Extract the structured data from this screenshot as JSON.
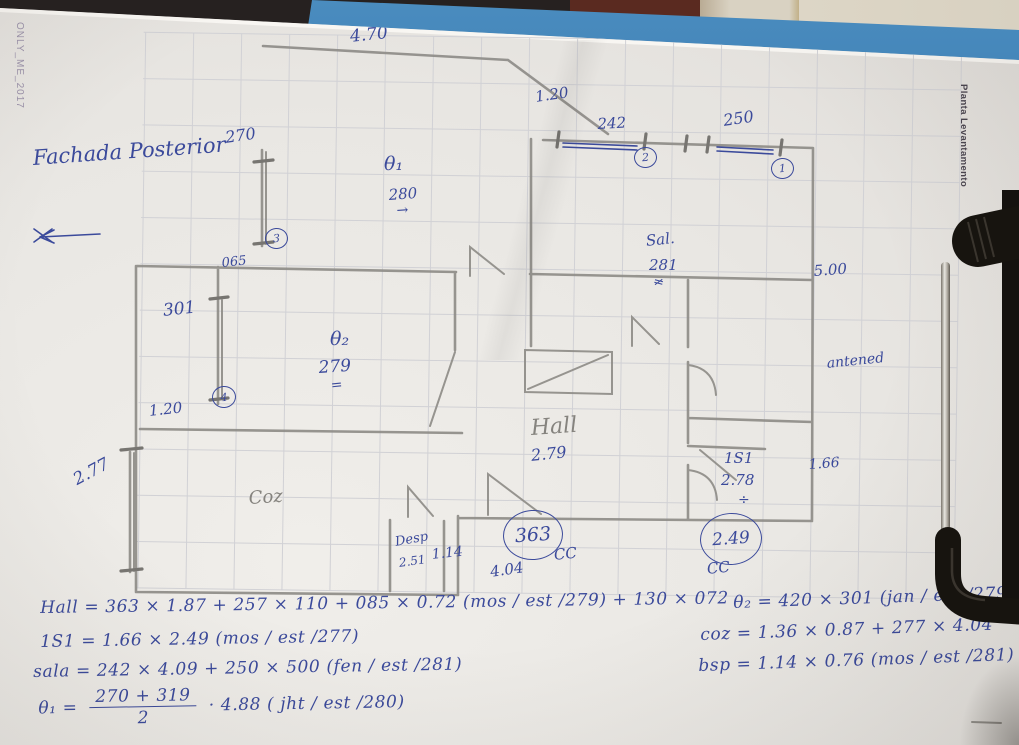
{
  "colors": {
    "ink": "#3b4a9b",
    "pencil": "#8f8d88",
    "clipboard_blue": "#2f6fa8",
    "paper": "#e9e7e3"
  },
  "side_labels": {
    "left_vertical": "ONLY_ME_2017",
    "right_vertical": "Planta Levantamento"
  },
  "header_note": {
    "text": "Fachada Posterior"
  },
  "plan": {
    "annotations": [
      {
        "name": "dim-470",
        "text": "4.70",
        "x": 349,
        "y": 27,
        "size": 17,
        "color": "ink",
        "rot": -6
      },
      {
        "name": "dim-270",
        "text": "270",
        "x": 224,
        "y": 128,
        "size": 16,
        "color": "ink",
        "rot": -8
      },
      {
        "name": "dim-120-top",
        "text": "1.20",
        "x": 534,
        "y": 88,
        "size": 15,
        "color": "ink",
        "rot": -8
      },
      {
        "name": "dim-242",
        "text": "242",
        "x": 597,
        "y": 115,
        "size": 15,
        "color": "ink",
        "rot": -3
      },
      {
        "name": "dim-250",
        "text": "250",
        "x": 722,
        "y": 111,
        "size": 16,
        "color": "ink",
        "rot": -8
      },
      {
        "name": "label-theta1",
        "text": "θ₁",
        "x": 384,
        "y": 153,
        "size": 19,
        "color": "ink",
        "rot": 0
      },
      {
        "name": "dim-280",
        "text": "280",
        "x": 388,
        "y": 186,
        "size": 15,
        "color": "ink",
        "rot": -4
      },
      {
        "name": "arrow-280",
        "text": "→",
        "x": 396,
        "y": 203,
        "size": 14,
        "color": "ink",
        "rot": -4
      },
      {
        "name": "room-sala",
        "text": "Sal.",
        "x": 645,
        "y": 232,
        "size": 15,
        "color": "ink",
        "rot": -6
      },
      {
        "name": "dim-281",
        "text": "281",
        "x": 649,
        "y": 256,
        "size": 15,
        "color": "ink",
        "rot": 0
      },
      {
        "name": "mark-281",
        "text": "≠",
        "x": 655,
        "y": 274,
        "size": 13,
        "color": "ink",
        "rot": 14
      },
      {
        "name": "dim-500",
        "text": "5.00",
        "x": 813,
        "y": 262,
        "size": 15,
        "color": "ink",
        "rot": -4
      },
      {
        "name": "note-antened",
        "text": "antened",
        "x": 826,
        "y": 356,
        "size": 14,
        "color": "ink",
        "rot": -6
      },
      {
        "name": "dim-065",
        "text": "065",
        "x": 221,
        "y": 256,
        "size": 13,
        "color": "ink",
        "rot": -6
      },
      {
        "name": "dim-301",
        "text": "301",
        "x": 162,
        "y": 301,
        "size": 17,
        "color": "ink",
        "rot": -6
      },
      {
        "name": "label-theta2",
        "text": "θ₂",
        "x": 330,
        "y": 328,
        "size": 19,
        "color": "ink",
        "rot": 0
      },
      {
        "name": "dim-279-theta2",
        "text": "279",
        "x": 318,
        "y": 358,
        "size": 17,
        "color": "ink",
        "rot": -4
      },
      {
        "name": "mark-279",
        "text": "=",
        "x": 330,
        "y": 378,
        "size": 14,
        "color": "ink",
        "rot": -6
      },
      {
        "name": "dim-120-left",
        "text": "1.20",
        "x": 148,
        "y": 402,
        "size": 15,
        "color": "ink",
        "rot": -6
      },
      {
        "name": "dim-277-left",
        "text": "2.77",
        "x": 70,
        "y": 472,
        "size": 17,
        "color": "ink",
        "rot": -28
      },
      {
        "name": "room-hall",
        "text": "Hall",
        "x": 530,
        "y": 416,
        "size": 22,
        "color": "pencil",
        "rot": -4
      },
      {
        "name": "dim-279-hall",
        "text": "2.79",
        "x": 530,
        "y": 446,
        "size": 16,
        "color": "ink",
        "rot": -6
      },
      {
        "name": "room-coz",
        "text": "Coz",
        "x": 248,
        "y": 488,
        "size": 18,
        "color": "pencil",
        "rot": -4
      },
      {
        "name": "room-desp",
        "text": "Desp",
        "x": 394,
        "y": 535,
        "size": 13,
        "color": "ink",
        "rot": -10
      },
      {
        "name": "dim-251",
        "text": "2.51",
        "x": 398,
        "y": 556,
        "size": 12,
        "color": "ink",
        "rot": -8
      },
      {
        "name": "dim-114",
        "text": "1.14",
        "x": 431,
        "y": 547,
        "size": 14,
        "color": "ink",
        "rot": -6
      },
      {
        "name": "room-1s1",
        "text": "1S1",
        "x": 724,
        "y": 449,
        "size": 15,
        "color": "ink",
        "rot": 0
      },
      {
        "name": "dim-278",
        "text": "2.78",
        "x": 721,
        "y": 471,
        "size": 15,
        "color": "ink",
        "rot": 0
      },
      {
        "name": "mark-divide",
        "text": "÷",
        "x": 738,
        "y": 492,
        "size": 14,
        "color": "ink",
        "rot": 0
      },
      {
        "name": "dim-166",
        "text": "1.66",
        "x": 808,
        "y": 457,
        "size": 14,
        "color": "ink",
        "rot": -4
      },
      {
        "name": "dim-404",
        "text": "4.04",
        "x": 489,
        "y": 563,
        "size": 15,
        "color": "ink",
        "rot": -8
      },
      {
        "name": "label-cc-1",
        "text": "CC",
        "x": 553,
        "y": 546,
        "size": 15,
        "color": "ink",
        "rot": -6
      },
      {
        "name": "label-cc-2",
        "text": "CC",
        "x": 706,
        "y": 560,
        "size": 15,
        "color": "ink",
        "rot": -6
      }
    ],
    "circles": [
      {
        "name": "circled-2",
        "text": "2",
        "x": 634,
        "y": 147,
        "w": 21,
        "h": 19,
        "size": 11
      },
      {
        "name": "circled-1",
        "text": "1",
        "x": 771,
        "y": 158,
        "w": 21,
        "h": 19,
        "size": 11
      },
      {
        "name": "circled-3",
        "text": "3",
        "x": 265,
        "y": 228,
        "w": 21,
        "h": 19,
        "size": 11
      },
      {
        "name": "circled-4",
        "text": "4",
        "x": 212,
        "y": 386,
        "w": 22,
        "h": 20,
        "size": 11
      },
      {
        "name": "circled-363",
        "text": "363",
        "x": 503,
        "y": 510,
        "w": 58,
        "h": 48,
        "size": 19
      },
      {
        "name": "circled-249",
        "text": "2.49",
        "x": 700,
        "y": 513,
        "w": 60,
        "h": 50,
        "size": 17
      }
    ]
  },
  "formulas": {
    "left": [
      "Hall = 363 × 1.87 + 257 × 110 + 085 × 0.72 (mos / est /279) + 130 × 072",
      "1S1 = 1.66 × 2.49 (mos / est /277)",
      "sala = 242 × 4.09 + 250 × 500 (fen / est /281)"
    ],
    "theta1": {
      "lhs": "θ₁ =",
      "numerator": "270 + 319",
      "denominator": "2",
      "rhs": "· 4.88  ( jht / est /280)"
    },
    "right": [
      "θ₂ = 420 × 301 (jan / est /279)",
      "coz = 1.36 × 0.87 + 277 × 4.04",
      "bsp = 1.14 × 0.76 (mos / est /281)"
    ]
  }
}
